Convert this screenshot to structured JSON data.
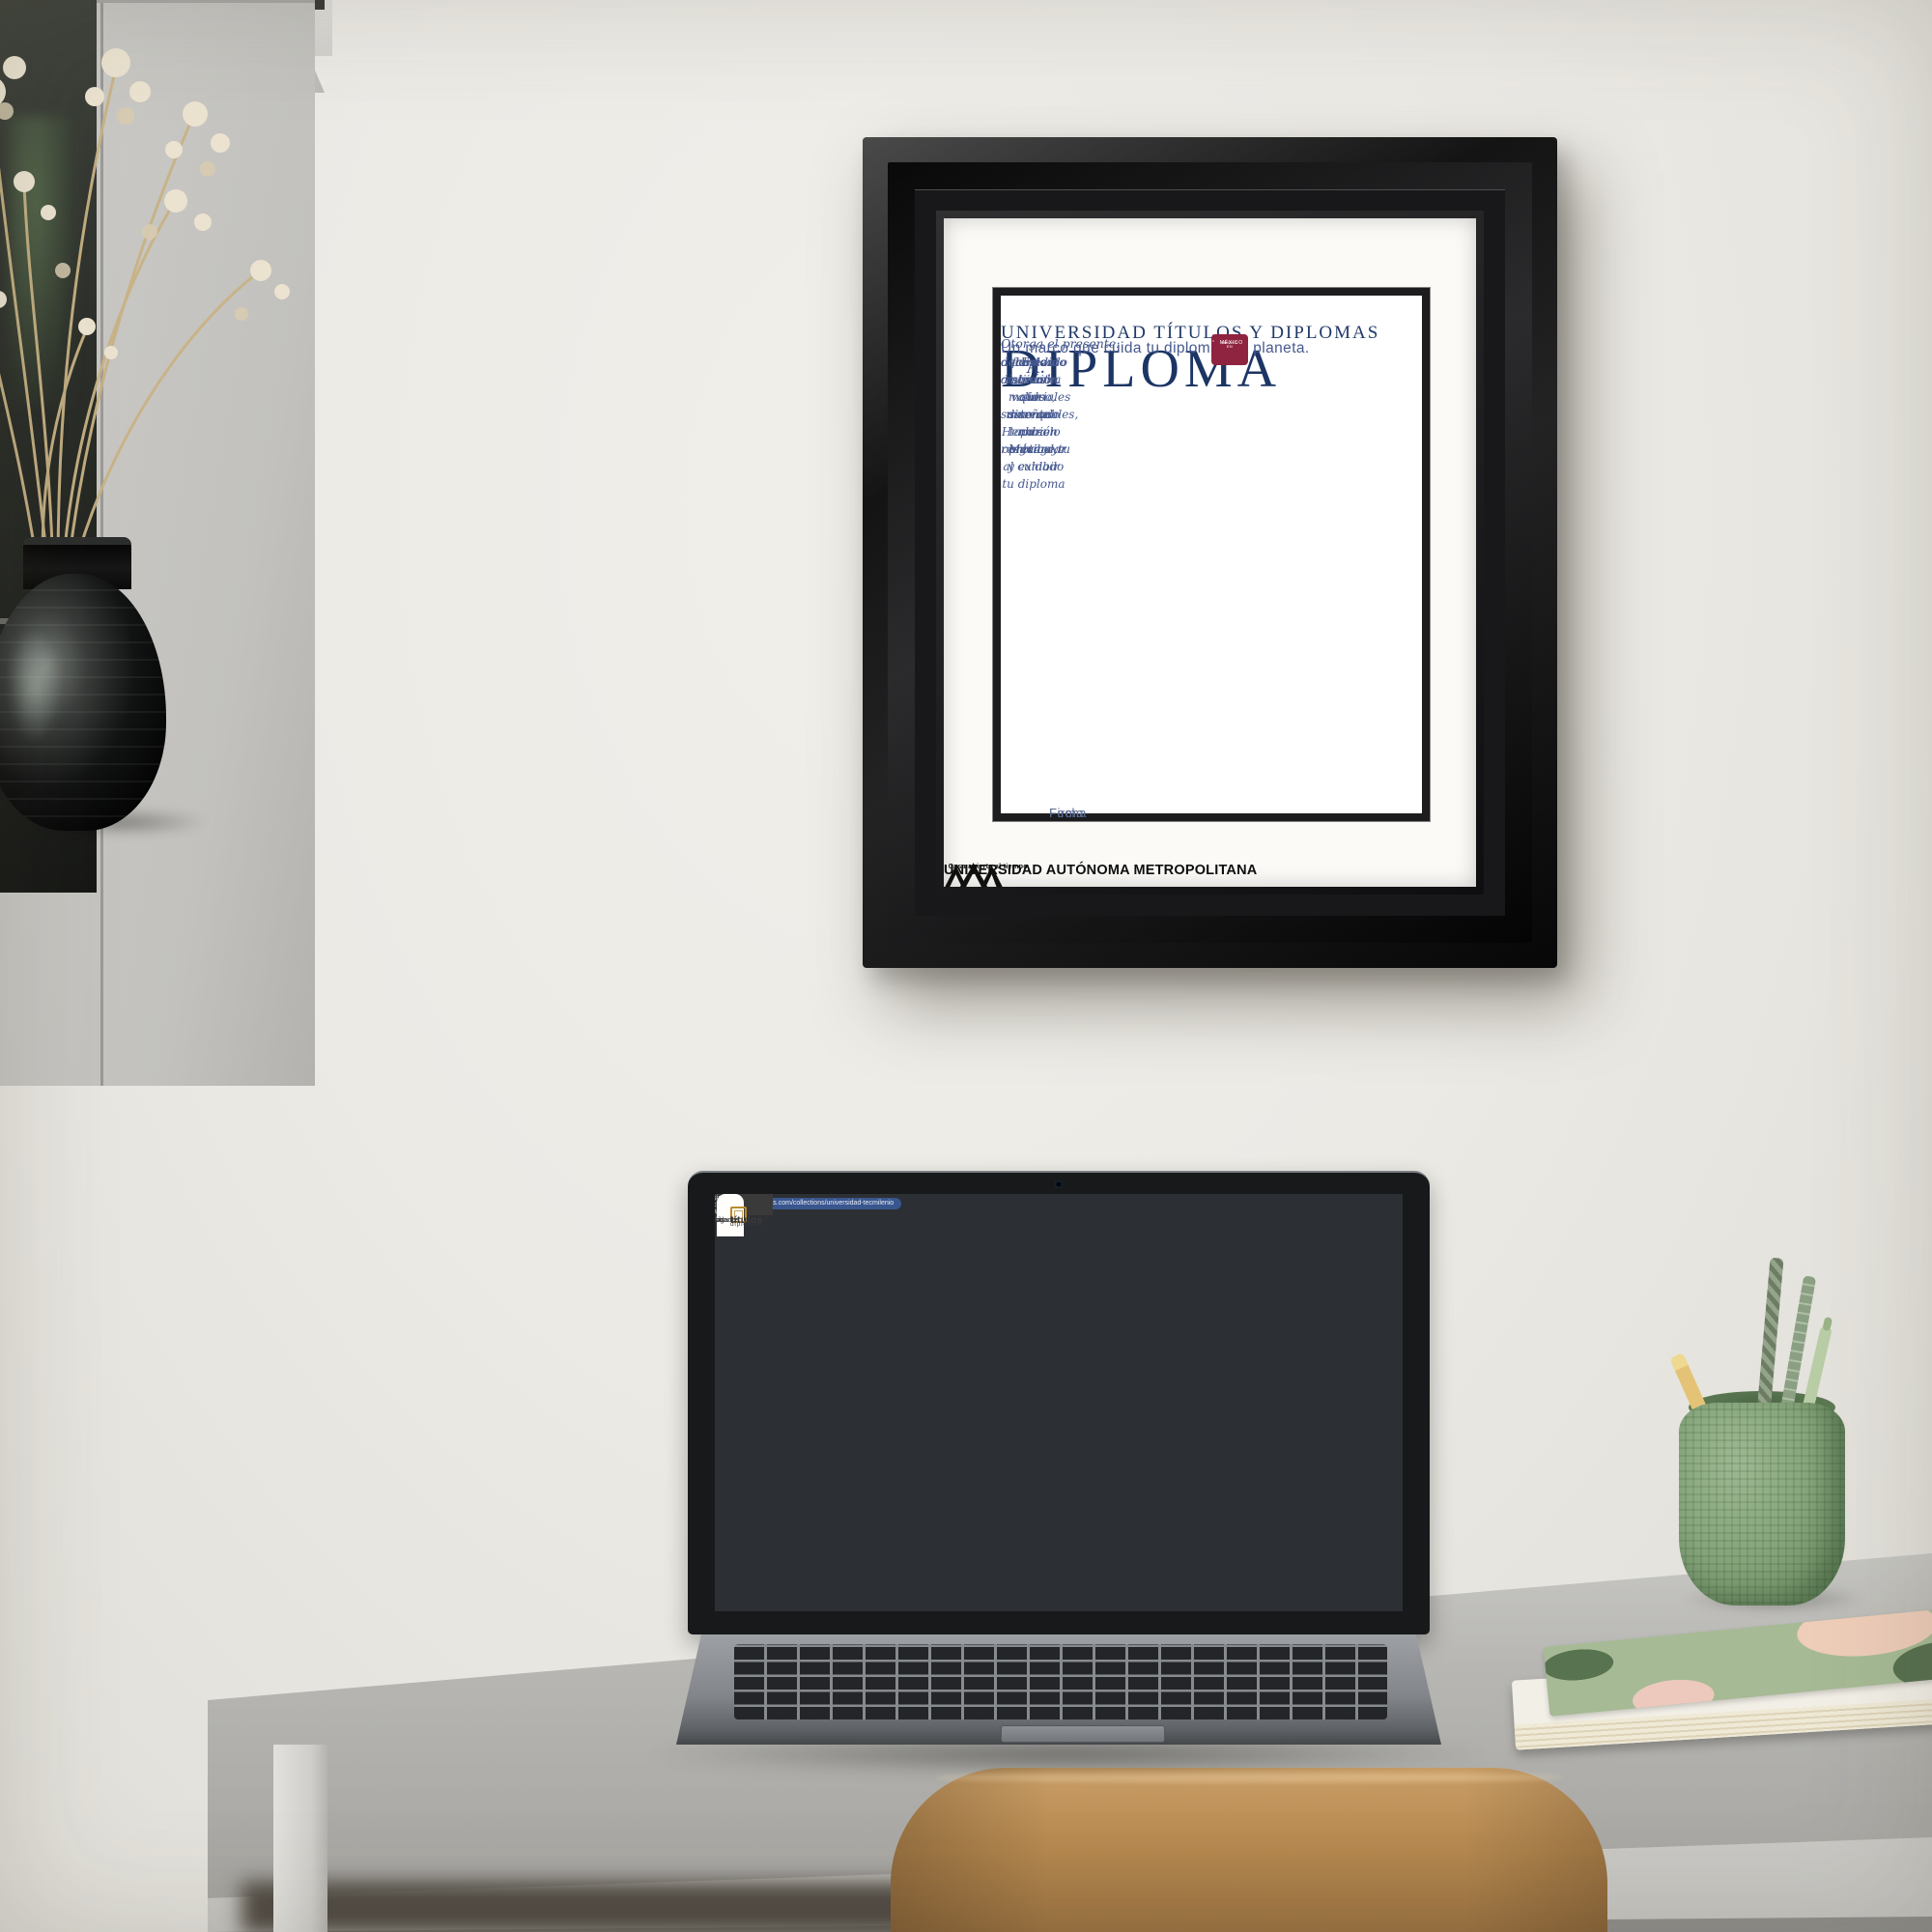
{
  "diploma": {
    "university": "UNIVERSIDAD TÍTULOS Y DIPLOMAS",
    "presents": "Otorga el presente:",
    "title": "DIPLOMA",
    "recipient_label": "A:",
    "body_lines": [
      "Este marco ha sido diseñado para resguardar y exhibir tu diploma",
      "con la distinción que merece. Hecho en México",
      "fabricado con materiales sustentables,  no solo protege tu",
      "documento más valioso, sino que también contribuye al cuidado",
      "del medio ambiente."
    ],
    "tagline": "Un marco que cuida tu diploma y el planeta.",
    "badge": {
      "top": "HECHO EN",
      "bottom": "MÉXICO"
    },
    "date_label": "Fecha",
    "signature_label": "Firma",
    "uam": {
      "motto": "Casa abierta al tiempo",
      "name": "UNIVERSIDAD AUTÓNOMA METROPOLITANA"
    }
  },
  "laptop": {
    "chrome": {
      "icons": {
        "back": "‹",
        "forward": "›",
        "reload": "⟳",
        "star": "★",
        "menu": "⋮",
        "apps": "∷",
        "overflow": "»"
      },
      "url": "titulosydiplomas.com/collections/universidad-tecmilenio",
      "bookmarks": [
        "Recibidos - disen...",
        "Aprende a Ilustrar...",
        "Ilustración Digital",
        "Cómo hacer una Il...",
        "Free Photo | Living...",
        "Aprende a diseñar...",
        "Remesas en ventan...",
        "Free Transitions V...",
        "Free Video Templa...",
        "Charts of the High..."
      ],
      "all_bookmarks": "Todos los favoritos"
    },
    "announcement": {
      "left_arrow": "←",
      "text": "Envío sin costo a todo México",
      "right_arrow": "→",
      "social": {
        "facebook": "f",
        "instagram": "◎",
        "youtube": "▶",
        "tiktok": "♪"
      }
    },
    "site": {
      "logo": {
        "line1": "títulos",
        "line2": "y diplomas"
      },
      "nav": [
        "Inicio",
        "Universidades",
        "Encuéntranos en",
        "Blog"
      ],
      "toolbar": {
        "filter_button": "Ocultar filtros",
        "sort_label": "Ordenar por",
        "sort_value": "Más vendidos",
        "sort_caret": "▾"
      },
      "filters": {
        "heading": "Material",
        "collapse_caret": "∧",
        "options": [
          {
            "label": "Madera",
            "count": "(6)"
          },
          {
            "label": "Poliestireno",
            "count": "(6)"
          }
        ]
      },
      "mini": {
        "u1": "UNIVERSIDAD",
        "u2": "TECMILENIO",
        "brand": "TECMILENIO"
      },
      "products": [
        {
          "brand": "TÍTULOS Y DIPLOMAS",
          "title": "Marco Oficial en Color Negro con Relieves para Universidad Tecmilenio",
          "price_prefix": "A partir de",
          "price": "$ 2,149.00"
        },
        {
          "brand": "TÍTULOS Y DIPLOMAS",
          "title": "Marco Oficial en Color Negro con Relieves para Universidad Tecmilenio",
          "price_prefix": "A partir de",
          "price": "$ 2,149.00"
        },
        {
          "brand": "TÍTULOS Y DIPLOMAS",
          "title": "Marco Oficial en Color Negro con Relieves para Universidad Tecmilenio",
          "price_prefix": "A partir de",
          "price": "$ 2,599.00"
        }
      ]
    }
  },
  "colors": {
    "accent_gold": "#cfa968",
    "badge_maroon": "#8e2440",
    "diploma_navy": "#1f3a66",
    "chrome_blue": "#4a69a8",
    "announcement_gray": "#3a3a3b"
  }
}
